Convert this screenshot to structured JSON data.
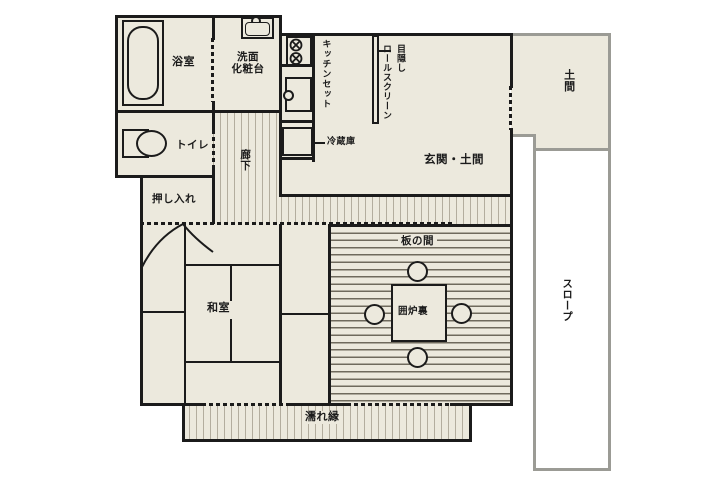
{
  "plan": {
    "type": "japanese-house-floor-plan",
    "rooms": {
      "bathroom": "浴室",
      "vanity_line1": "洗面",
      "vanity_line2": "化粧台",
      "toilet": "トイレ",
      "closet": "押し入れ",
      "corridor": "廊下",
      "kitchen": "キッチンセット",
      "fridge": "冷蔵庫",
      "screen_line1": "目隠し",
      "screen_line2": "ロールスクリーン",
      "genkan": "玄関・土間",
      "doma": "土間",
      "slope": "スロープ",
      "washitsu": "和室",
      "itanoma": "板の間",
      "irori": "囲炉裏",
      "nureen": "濡れ縁"
    },
    "fixtures": {
      "bathtub": "bathtub-icon",
      "washbasin": "washbasin-icon",
      "toilet_bowl": "toilet-icon",
      "stove_burners": "stove-burner-icon",
      "kitchen_sink": "kitchen-sink-icon",
      "refrigerator": "refrigerator-icon",
      "roll_screen": "roll-screen-icon",
      "hearth": "irori-hearth-icon",
      "seats": "seat-cushion-icon",
      "door_swing": "door-swing-icon"
    },
    "colors": {
      "floor": "#ece9dd",
      "wall": "#1b1b1b",
      "outdoor": "#9b9b95",
      "hatch": "#b3ad9e",
      "plank": "#6f6a5d",
      "bg": "#ffffff"
    }
  }
}
